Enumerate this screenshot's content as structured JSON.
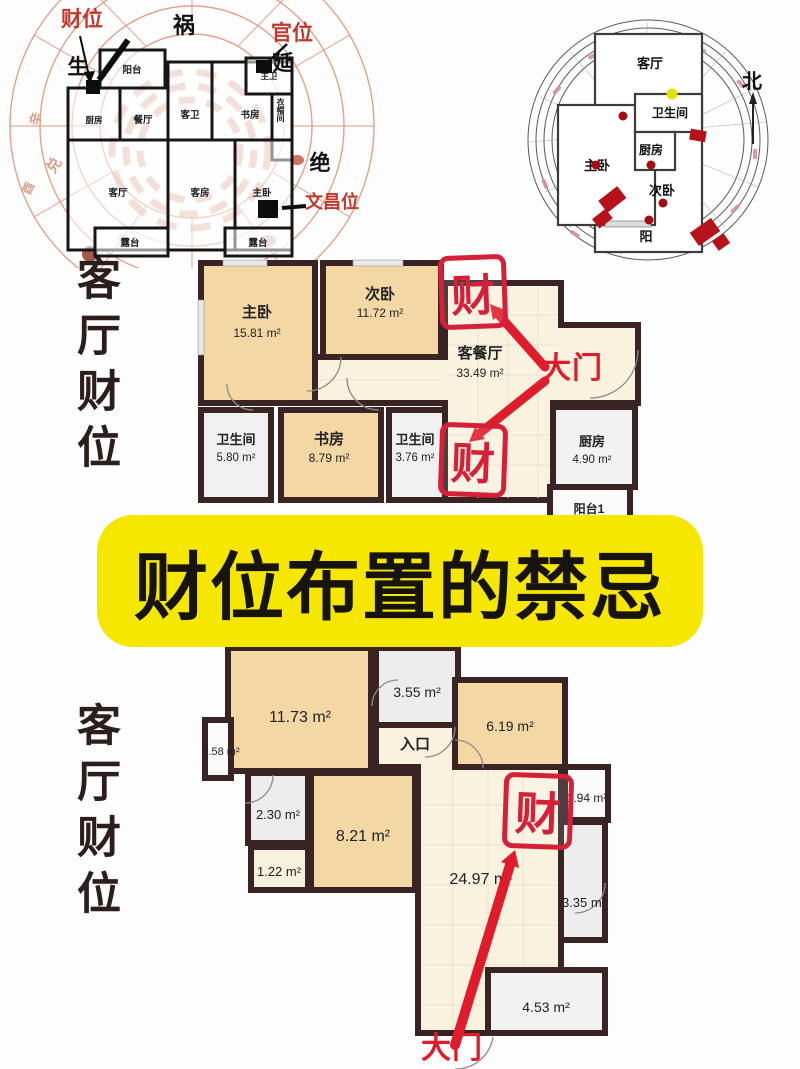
{
  "title_banner": {
    "text": "财位布置的禁忌"
  },
  "side_labels": {
    "top": "客厅财位",
    "bottom": "客厅财位"
  },
  "bagua_compass": {
    "position_labels": [
      {
        "text": "财位",
        "color": "#c0392b"
      },
      {
        "text": "祸",
        "color": "#111111"
      },
      {
        "text": "官位",
        "color": "#c0392b"
      },
      {
        "text": "生",
        "color": "#111111"
      },
      {
        "text": "延",
        "color": "#111111"
      },
      {
        "text": "绝",
        "color": "#111111"
      },
      {
        "text": "文昌位",
        "color": "#c0392b"
      }
    ],
    "rooms": [
      "阳台",
      "厨房",
      "餐厅",
      "客卫",
      "书房",
      "主卫",
      "衣帽间",
      "客厅",
      "客房",
      "主卧",
      "露台",
      "露台"
    ],
    "ring_chars": [
      "辛",
      "兑",
      "酉",
      "申"
    ]
  },
  "ring_compass": {
    "north_label": "北",
    "rooms": [
      "客厅",
      "卫生间",
      "厨房",
      "主卧",
      "次卧",
      "阳"
    ]
  },
  "floorplan_mid": {
    "rooms": [
      {
        "name": "主卧",
        "area": "15.81 m²"
      },
      {
        "name": "次卧",
        "area": "11.72 m²"
      },
      {
        "name": "客餐厅",
        "area": "33.49 m²"
      },
      {
        "name": "卫生间",
        "area": "5.80 m²"
      },
      {
        "name": "书房",
        "area": "8.79 m²"
      },
      {
        "name": "卫生间",
        "area": "3.76 m²"
      },
      {
        "name": "厨房",
        "area": "4.90 m²"
      },
      {
        "name": "阳台1",
        "area": ""
      }
    ],
    "stamp_upper": "财",
    "stamp_lower": "财",
    "door_label": "大门"
  },
  "floorplan_bottom": {
    "areas": [
      "11.73 m²",
      "3.55 m²",
      "6.19 m²",
      "0.58 m²",
      "2.30 m²",
      "8.21 m²",
      "1.22 m²",
      "24.97 m²",
      "1.94 m²",
      "3.35 m²",
      "4.53 m²"
    ],
    "entry_label": "入口",
    "stamp": "财",
    "door_label": "大门"
  },
  "colors": {
    "banner_yellow": "#f6e700",
    "stamp_red": "#d6203a",
    "arrow_red": "#e01b2c",
    "wall_dark": "#3a2323",
    "room_tan": "#f3d7a4",
    "room_cream": "#f8f2df",
    "compass_salmon": "#dd9379"
  }
}
